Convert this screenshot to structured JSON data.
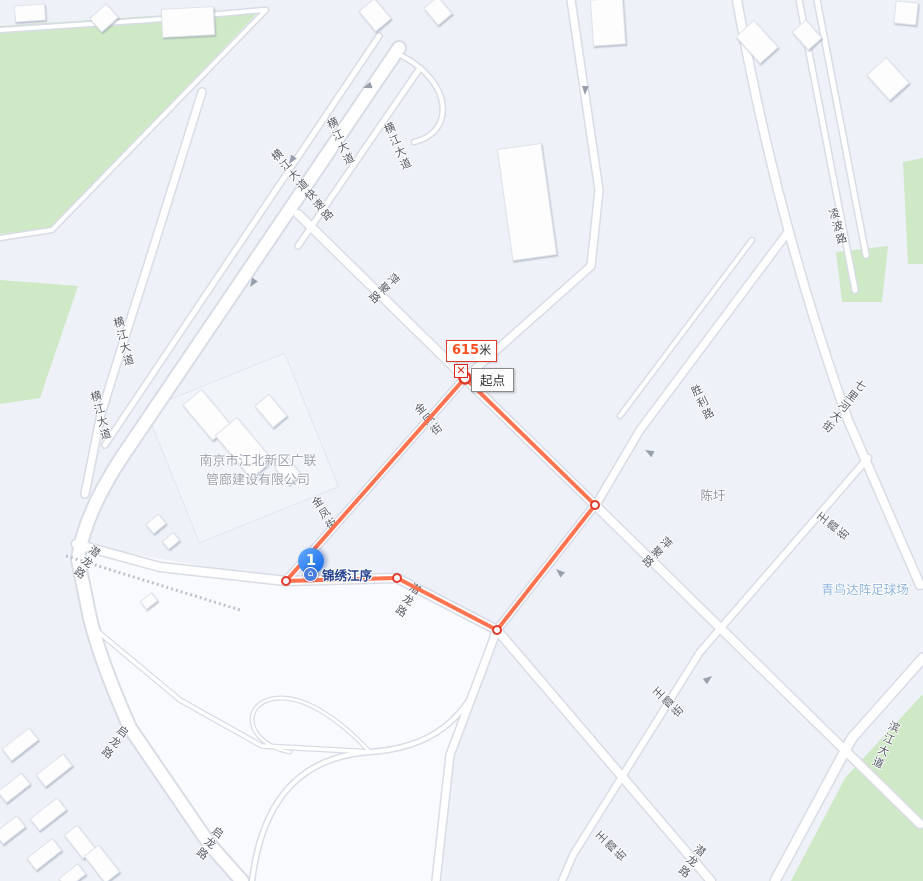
{
  "map": {
    "measurement": {
      "distance_value": "615",
      "distance_unit": "米",
      "start_label": "起点",
      "delete_icon": "✕"
    },
    "route": {
      "color": "#FF7350",
      "vertex_ring_color": "#E23B2E",
      "points": [
        [
          465,
          378
        ],
        [
          286,
          581
        ],
        [
          397,
          578
        ],
        [
          497,
          630
        ],
        [
          595,
          505
        ],
        [
          465,
          378
        ]
      ]
    },
    "marker": {
      "number": "1",
      "poi_label": "锦绣江序"
    },
    "road_labels": [
      {
        "text": "横江大道快速路",
        "x": 302,
        "y": 186,
        "rot": -40
      },
      {
        "text": "横江大道",
        "x": 340,
        "y": 142,
        "rot": -24
      },
      {
        "text": "横江大道",
        "x": 397,
        "y": 147,
        "rot": -24
      },
      {
        "text": "横江大道",
        "x": 123,
        "y": 342,
        "rot": -14
      },
      {
        "text": "横江大道",
        "x": 100,
        "y": 416,
        "rot": -14
      },
      {
        "text": "萍聚路",
        "x": 383,
        "y": 288,
        "rot": 46
      },
      {
        "text": "萍聚路",
        "x": 656,
        "y": 552,
        "rot": 44
      },
      {
        "text": "金凤街",
        "x": 428,
        "y": 420,
        "rot": -38
      },
      {
        "text": "金凤街",
        "x": 324,
        "y": 514,
        "rot": -32
      },
      {
        "text": "潜龙路",
        "x": 86,
        "y": 562,
        "rot": 34
      },
      {
        "text": "潜龙路",
        "x": 407,
        "y": 600,
        "rot": 32
      },
      {
        "text": "潜龙路",
        "x": 691,
        "y": 861,
        "rot": 36
      },
      {
        "text": "启龙路",
        "x": 114,
        "y": 742,
        "rot": 36
      },
      {
        "text": "启龙路",
        "x": 209,
        "y": 843,
        "rot": 36
      },
      {
        "text": "胜利路",
        "x": 702,
        "y": 403,
        "rot": -26
      },
      {
        "text": "七里河大街",
        "x": 843,
        "y": 406,
        "rot": 38
      },
      {
        "text": "凌波路",
        "x": 837,
        "y": 227,
        "rot": -16
      },
      {
        "text": "王霞街",
        "x": 833,
        "y": 527,
        "rot": -52
      },
      {
        "text": "王霞街",
        "x": 668,
        "y": 703,
        "rot": -46
      },
      {
        "text": "王霞街",
        "x": 611,
        "y": 847,
        "rot": -46
      },
      {
        "text": "滨江大道",
        "x": 885,
        "y": 745,
        "rot": 24
      }
    ],
    "places": {
      "company_line1": "南京市江北新区广联",
      "company_line2": "管廊建设有限公司",
      "village": "陈圩",
      "stadium": "青鸟达阵足球场"
    }
  },
  "colors": {
    "background": "#EEF1F7",
    "white_zone": "#F9FAFD",
    "road_fill": "#FFFFFF",
    "road_casing": "#D8DCE5",
    "green_area": "#CFE8C6",
    "route_line": "#FF7350",
    "pin_blue": "#1E6FE8",
    "road_label_gray": "#545A64"
  }
}
